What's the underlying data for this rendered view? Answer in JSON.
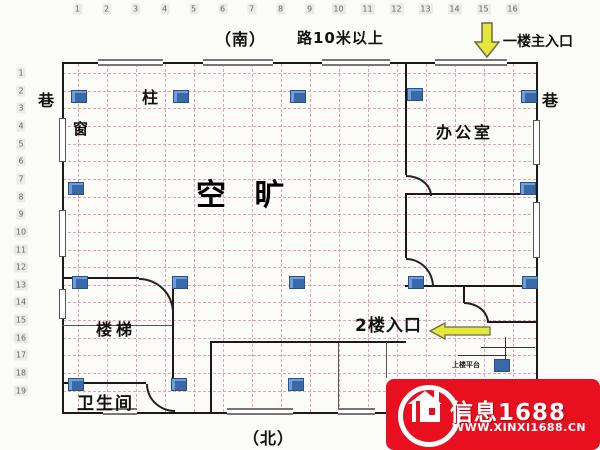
{
  "header": {
    "south_label": "（南）",
    "road_label": "路10米以上",
    "main_entrance_label": "一楼主入口"
  },
  "grid": {
    "col_numbers": [
      "1",
      "2",
      "3",
      "4",
      "5",
      "6",
      "7",
      "8",
      "9",
      "10",
      "11",
      "12",
      "13",
      "14",
      "15",
      "16"
    ],
    "row_numbers": [
      "1",
      "2",
      "3",
      "4",
      "5",
      "6",
      "7",
      "8",
      "9",
      "10",
      "11",
      "12",
      "13",
      "14",
      "15",
      "16",
      "17",
      "18",
      "19"
    ]
  },
  "plan": {
    "alley_left": "巷",
    "alley_right": "巷",
    "column_label": "柱",
    "window_label": "窗",
    "open_space": "空 旷",
    "office": "办公室",
    "stairs": "楼梯",
    "toilet": "卫生间",
    "second_floor_entrance": "2楼入口",
    "platform_note": "上楼平台"
  },
  "footer": {
    "north_label": "（北）"
  },
  "watermark": {
    "brand": "信息1688",
    "site": "WWW.XINXI1688.CN"
  },
  "icons": {
    "main_entrance_arrow": "arrow-down",
    "second_floor_arrow": "arrow-left",
    "column_marker": "blue-square",
    "door_swing": "quarter-arc",
    "watermark_logo": "house-in-circle"
  },
  "colors": {
    "wall": "#1a1a1a",
    "grid_line": "#e78fae",
    "column_fill": "#3a69a8",
    "arrow_fill": "#e5e838",
    "arrow_stroke": "#6b6b4f",
    "opening_stroke": "#767676",
    "watermark_bg": "#e8101e"
  }
}
